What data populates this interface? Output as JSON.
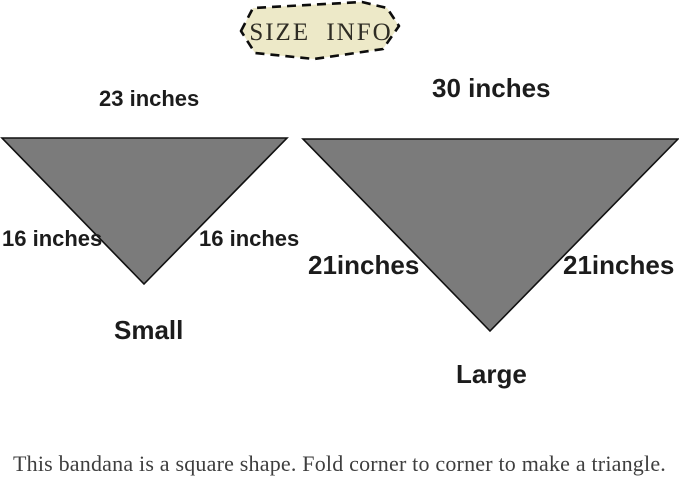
{
  "title": {
    "text": "SIZE INFO",
    "blob_fill": "#ede9c8",
    "blob_border": "#0d0d0d"
  },
  "small_bandana": {
    "top_label": "23 inches",
    "left_label": "16 inches",
    "right_label": "16 inches",
    "name": "Small",
    "fill_color": "#7b7b7b",
    "outline_color": "#111111"
  },
  "large_bandana": {
    "top_label": "30 inches",
    "left_label": "21inches",
    "right_label": "21inches",
    "name": "Large",
    "fill_color": "#7b7b7b",
    "outline_color": "#111111"
  },
  "footer": {
    "note": "This bandana is a square shape. Fold corner to corner to make a triangle."
  }
}
